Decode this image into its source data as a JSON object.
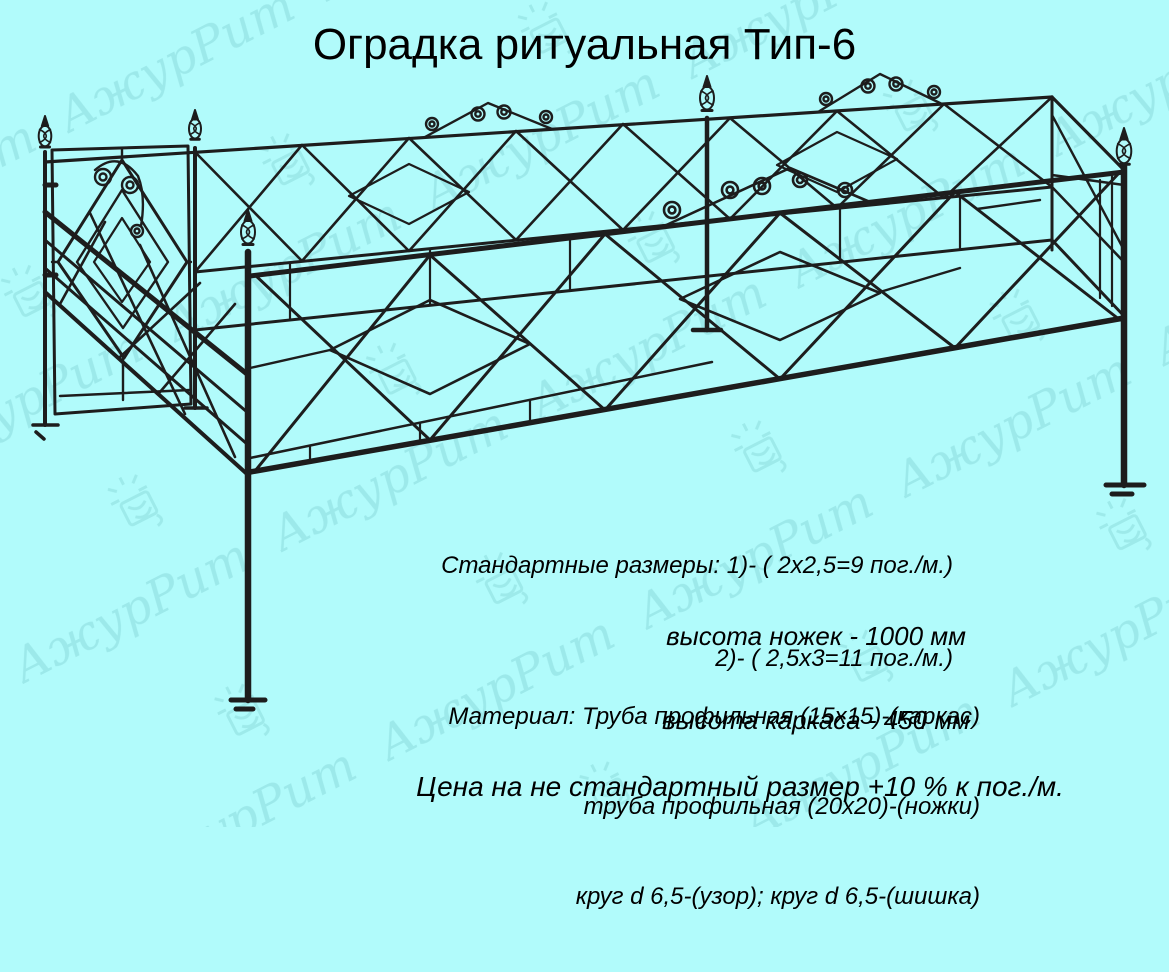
{
  "canvas": {
    "background_color": "#b1fbfb",
    "ink_color": "#1d1d1d",
    "watermark_color": "#1f7c80"
  },
  "title": "Оградка ритуальная Тип-6",
  "watermark": {
    "text": "АжурРит"
  },
  "specs": {
    "sizes_line1": "Стандартные размеры: 1)- ( 2х2,5=9 пог./м.)",
    "sizes_line2": "2)- ( 2,5х3=11 пог./м.)",
    "legs_height": "высота ножек - 1000 мм",
    "frame_height": "высота каркаса - 450 мм",
    "material_line1": "Материал: Труба профильная (15х15)-(каркас)",
    "material_line2": "труба профильная (20х20)-(ножки)",
    "material_line3": "круг d 6,5-(узор); круг d 6,5-(шишка)",
    "price_note": "Цена на не стандартный размер +10 % к пог./м."
  }
}
